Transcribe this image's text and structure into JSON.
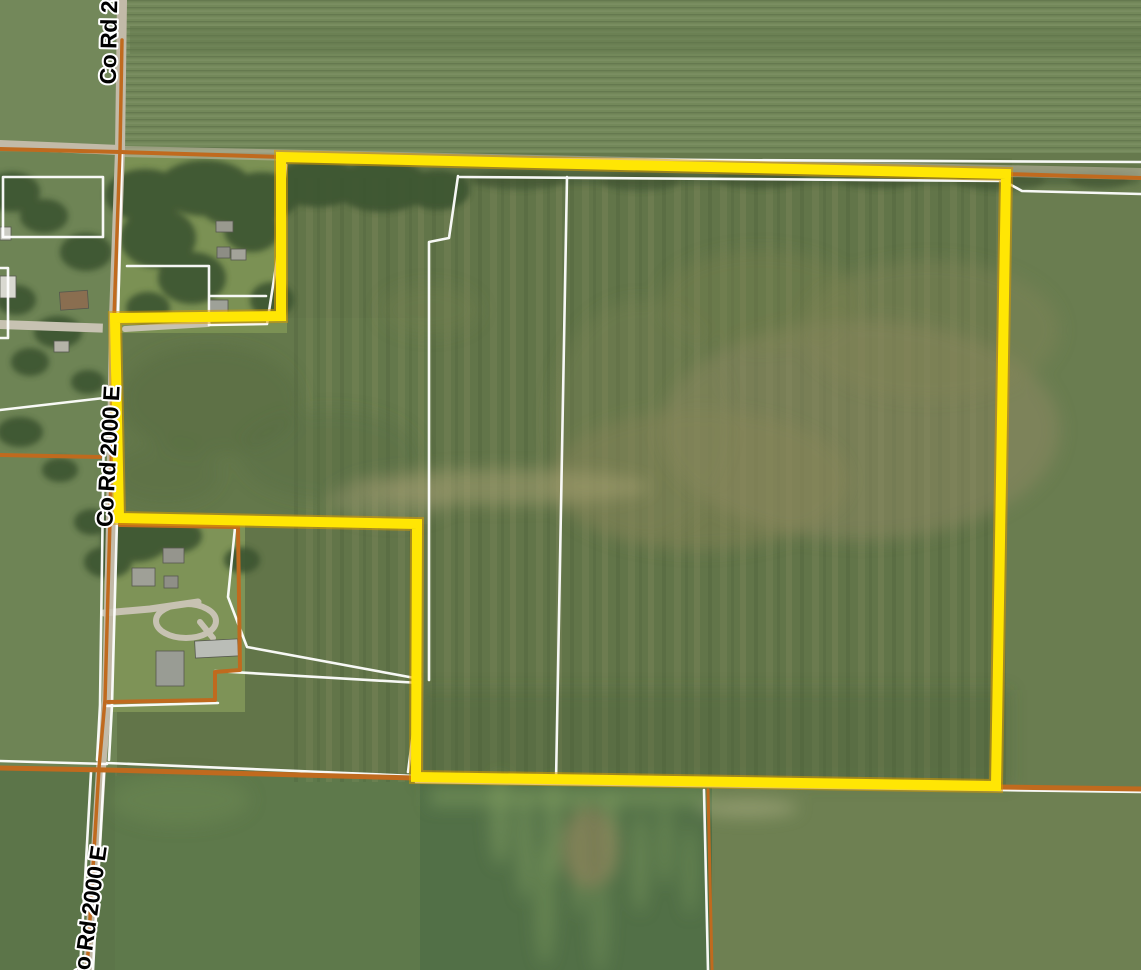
{
  "map": {
    "view_type": "aerial-parcel-map",
    "road_labels": [
      {
        "id": "top",
        "text": "Co Rd 2000 E"
      },
      {
        "id": "middle",
        "text": "Co Rd 2000 E"
      },
      {
        "id": "bottom",
        "text": "Co Rd 2000 E"
      }
    ],
    "colors": {
      "parcel_highlight": "#FFE604",
      "parcel_highlight_glow": "#D89B00",
      "parcel_line": "#FFFFFF",
      "section_line": "#C06A1E",
      "road_surface": "#C2BAA8",
      "label_text": "#000000",
      "label_halo": "#FFFFFF"
    }
  }
}
